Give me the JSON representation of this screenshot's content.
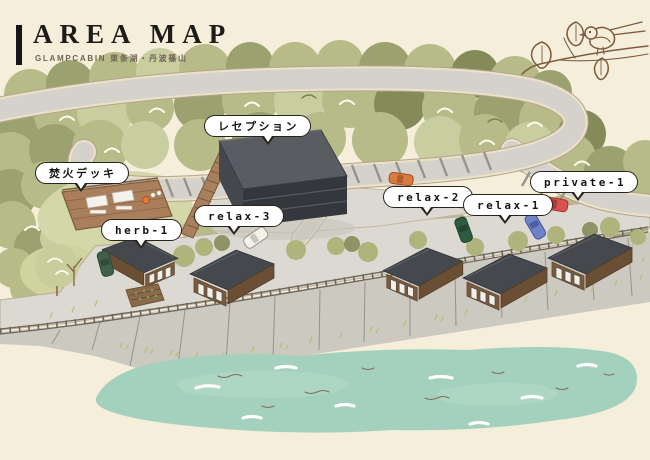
{
  "header": {
    "title": "AREA MAP",
    "subtitle": "GLAMPCABIN 東条湖・丹波篠山"
  },
  "map": {
    "labels": [
      {
        "id": "bonfire-deck",
        "text": "焚火デッキ"
      },
      {
        "id": "reception",
        "text": "レセプション"
      },
      {
        "id": "herb-1",
        "text": "herb-1"
      },
      {
        "id": "relax-3",
        "text": "relax-3"
      },
      {
        "id": "relax-2",
        "text": "relax-2"
      },
      {
        "id": "relax-1",
        "text": "relax-1"
      },
      {
        "id": "private-1",
        "text": "private-1"
      }
    ],
    "illustration_elements": [
      "forest",
      "winding-road",
      "reception-building",
      "bonfire-deck",
      "wooden-stairs",
      "guest-cabins",
      "parked-cars",
      "guardrail",
      "stone-embankment",
      "pond",
      "bird-on-branch-icon"
    ],
    "colors": {
      "background": "#f5eedb",
      "forest_green": "#b6bb88",
      "forest_dark": "#9ba26f",
      "forest_light": "#c9cea1",
      "road": "#d4d2ca",
      "road_edge": "#b3a48c",
      "building_dark": "#45484c",
      "wood_brown": "#a87e5b",
      "pond_teal": "#a4d1bd",
      "embankment_gray": "#ccc9c1",
      "bubble_border": "#27251f",
      "car_red": "#d95152",
      "car_blue": "#7083c8",
      "car_green": "#41604a",
      "car_orange": "#d97a3f",
      "car_white": "#f2f1ea"
    }
  }
}
